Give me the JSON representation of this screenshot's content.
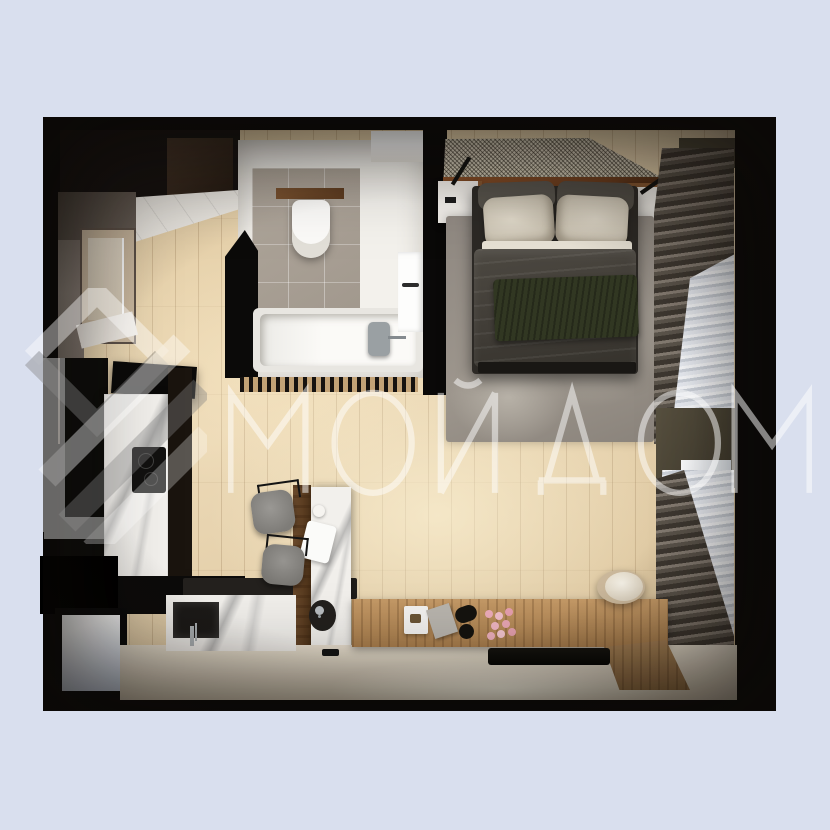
{
  "watermark": {
    "text": "МОЙ ДОМ",
    "logo_name": "house-logo"
  },
  "palette": {
    "background": "#d9dfee",
    "wall_black": "#0b0a09",
    "floor_wood": "#e6d2ab",
    "bathroom_white": "#f3f1ec",
    "bathroom_tile": "#a69d92",
    "rug_gray": "#9a938b",
    "bed_blanket": "#45413b",
    "bed_throw_green": "#303621",
    "pillow_beige": "#d5cebf",
    "curtain_dark": "#6b645c",
    "curtain_sheer": "#eef0f4",
    "counter_cream": "#e7ddcb",
    "cabinet_wood": "#b98a58",
    "marble_white": "#f2f0ec",
    "olive_wall": "#4f4839",
    "concrete": "#8a8078",
    "watermark_white": "#ffffff"
  },
  "scene": {
    "type": "top-down 3D render of a studio apartment floor plan",
    "rooms": [
      {
        "name": "hallway",
        "items": [
          "entry-door",
          "dark-wardrobe",
          "tall-cabinets"
        ]
      },
      {
        "name": "bathroom",
        "items": [
          "toilet",
          "wood-shelf",
          "tile-floor",
          "bathtub",
          "tub-faucet",
          "door",
          "slatted-screen"
        ]
      },
      {
        "name": "kitchen",
        "items": [
          "extractor-hood",
          "left-cooktop",
          "marble-counter",
          "kettle",
          "island-counter",
          "island-sink",
          "bar-stool-1",
          "bar-stool-2",
          "bench",
          "niche-with-faucet",
          "cream-countertop",
          "tv-screen",
          "wood-sideboard",
          "outlet",
          "table-lamp",
          "flowers",
          "book",
          "remote",
          "pouf"
        ]
      },
      {
        "name": "bedroom",
        "items": [
          "mesh-ceiling-panel",
          "headboard-shelf",
          "nightstand-left",
          "nightstand-right",
          "reading-lamp-left",
          "reading-lamp-right",
          "backrest-cushions",
          "pillow-left",
          "pillow-right",
          "sheet",
          "blanket",
          "green-throw",
          "rug",
          "curtain-window-top",
          "curtain-window-bottom",
          "olive-wall-panel",
          "window-glimpse"
        ]
      },
      {
        "name": "left-wall",
        "items": [
          "concrete-wall",
          "balcony-window-door",
          "white-ceiling-wedge",
          "top-vent-panel"
        ]
      }
    ]
  }
}
